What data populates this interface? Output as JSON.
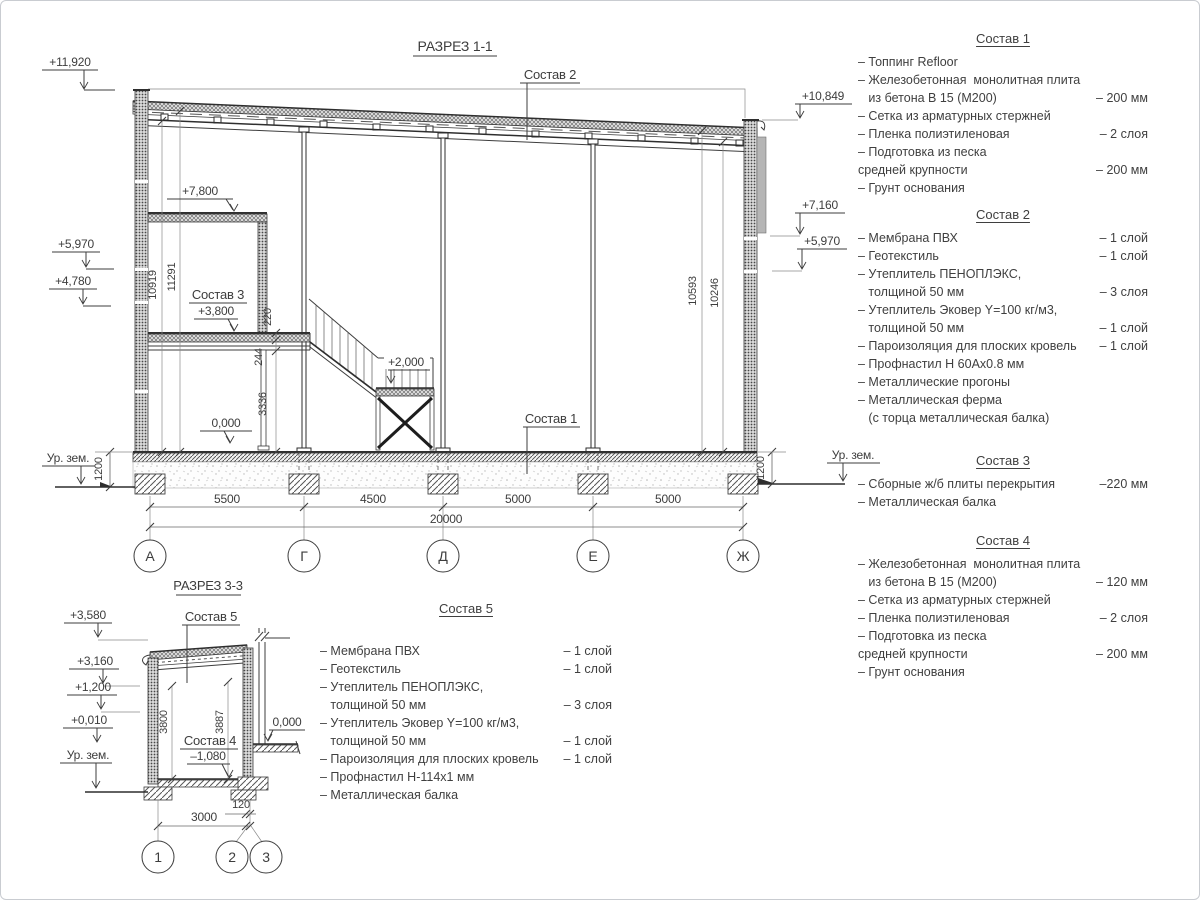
{
  "section1": {
    "title": "РАЗРЕЗ 1-1",
    "axes": [
      "А",
      "Г",
      "Д",
      "Е",
      "Ж"
    ],
    "span_dims": [
      "5500",
      "4500",
      "5000",
      "5000"
    ],
    "total_dim": "20000",
    "elev_left": [
      "+11,920",
      "+5,970",
      "+4,780"
    ],
    "elev_right": [
      "+10,849",
      "+7,160",
      "+5,970"
    ],
    "ground_left": "Ур. зем.",
    "ground_right": "Ур. зем.",
    "depth_left": "1200",
    "depth_right": "1200",
    "h_left": [
      "10919",
      "11291"
    ],
    "h_right": [
      "10593",
      "10246"
    ],
    "mezz_dims": [
      "220",
      "244",
      "3336"
    ],
    "callout_roof": "Состав 2",
    "callout_floor": "Состав 1",
    "callout_mezz": "Состав 3",
    "lvl_upper": "+7,800",
    "lvl_mezz": "+3,800",
    "lvl_landing": "+2,000",
    "lvl_zero": "0,000"
  },
  "section3": {
    "title": "РАЗРЕЗ 3-3",
    "axes": [
      "1",
      "2",
      "3"
    ],
    "elev": [
      "+3,580",
      "+3,160",
      "+1,200",
      "+0,010"
    ],
    "ground": "Ур. зем.",
    "callout_roof": "Состав 5",
    "callout_floor": "Состав 4",
    "lvl_floor": "–1,080",
    "lvl_zero": "0,000",
    "h_dims": [
      "3800",
      "3887"
    ],
    "w_dim": "3000",
    "offset_dim": "120"
  },
  "compositions": [
    {
      "title": "Состав 1",
      "items": [
        {
          "name": "– Топпинг Refloor",
          "value": ""
        },
        {
          "name": "– Железобетонная  монолитная плита\n   из бетона В 15 (М200)",
          "value": "– 200 мм"
        },
        {
          "name": "– Сетка из арматурных стержней",
          "value": ""
        },
        {
          "name": "– Пленка полиэтиленовая",
          "value": "– 2 слоя"
        },
        {
          "name": "– Подготовка из песка\nсредней крупности",
          "value": "– 200 мм"
        },
        {
          "name": "– Грунт основания",
          "value": ""
        }
      ]
    },
    {
      "title": "Состав 2",
      "items": [
        {
          "name": "– Мембрана ПВХ",
          "value": "– 1 слой"
        },
        {
          "name": "– Геотекстиль",
          "value": "– 1 слой"
        },
        {
          "name": "– Утеплитель ПЕНОПЛЭКС,\n   толщиной 50 мм",
          "value": "– 3 слоя"
        },
        {
          "name": "– Утеплитель Эковер Y=100 кг/м3,\n   толщиной 50 мм",
          "value": "– 1 слой"
        },
        {
          "name": "– Пароизоляция для плоских кровель",
          "value": "– 1 слой"
        },
        {
          "name": "– Профнастил Н 60Ах0.8 мм",
          "value": ""
        },
        {
          "name": "– Металлические прогоны",
          "value": ""
        },
        {
          "name": "– Металлическая ферма\n   (с торца металлическая балка)",
          "value": ""
        }
      ]
    },
    {
      "title": "Состав 3",
      "items": [
        {
          "name": "– Сборные ж/б плиты перекрытия",
          "value": "–220 мм"
        },
        {
          "name": "– Металлическая балка",
          "value": ""
        }
      ]
    },
    {
      "title": "Состав 4",
      "items": [
        {
          "name": "– Железобетонная  монолитная плита\n   из бетона В 15 (М200)",
          "value": "– 120 мм"
        },
        {
          "name": "– Сетка из арматурных стержней",
          "value": ""
        },
        {
          "name": "– Пленка полиэтиленовая",
          "value": "– 2 слоя"
        },
        {
          "name": "– Подготовка из песка\nсредней крупности",
          "value": "– 200 мм"
        },
        {
          "name": "– Грунт основания",
          "value": ""
        }
      ]
    },
    {
      "title": "Состав 5",
      "items": [
        {
          "name": "– Мембрана ПВХ",
          "value": "– 1 слой"
        },
        {
          "name": "– Геотекстиль",
          "value": "– 1 слой"
        },
        {
          "name": "– Утеплитель ПЕНОПЛЭКС,\n   толщиной 50 мм",
          "value": "– 3 слоя"
        },
        {
          "name": "– Утеплитель Эковер Y=100 кг/м3,\n   толщиной 50 мм",
          "value": "– 1 слой"
        },
        {
          "name": "– Пароизоляция для плоских кровель",
          "value": "– 1 слой"
        },
        {
          "name": "– Профнастил Н-114х1 мм",
          "value": ""
        },
        {
          "name": "– Металлическая балка",
          "value": ""
        }
      ]
    }
  ]
}
